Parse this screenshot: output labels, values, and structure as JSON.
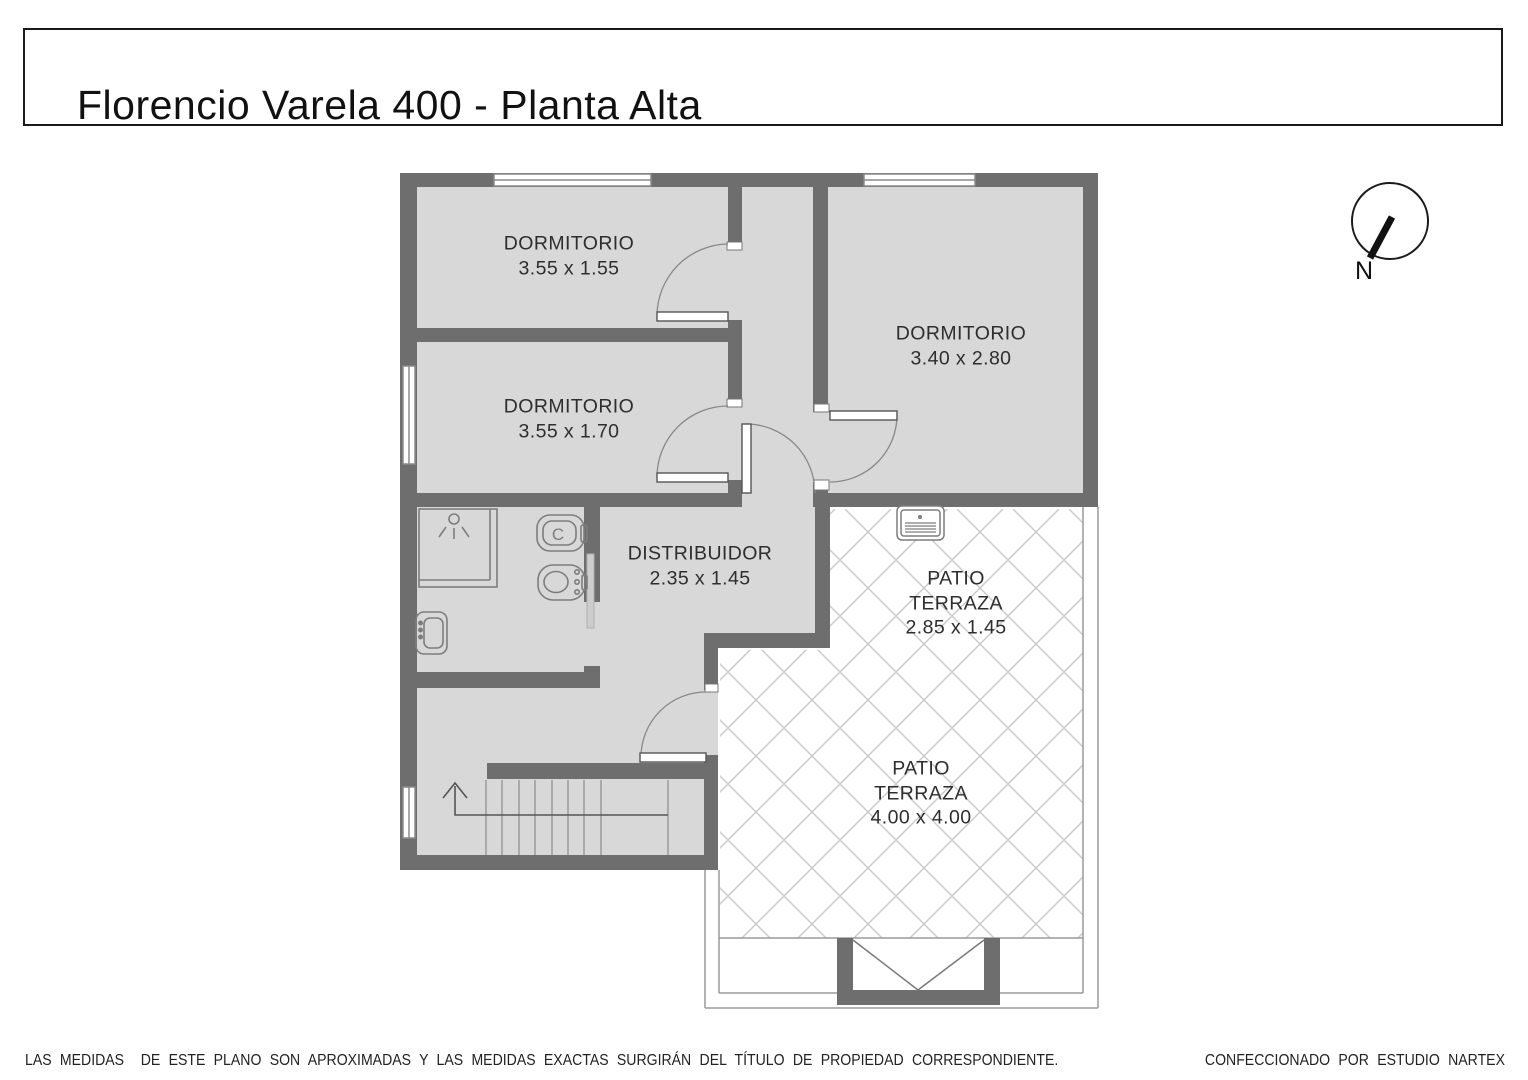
{
  "title": "Florencio Varela 400 - Planta Alta",
  "compass": {
    "label": "N"
  },
  "rooms": [
    {
      "id": "dormitorio-1",
      "lines": [
        "DORMITORIO",
        "3.55 x 1.55"
      ]
    },
    {
      "id": "dormitorio-2",
      "lines": [
        "DORMITORIO",
        "3.55 x 1.70"
      ]
    },
    {
      "id": "dormitorio-3",
      "lines": [
        "DORMITORIO",
        "3.40 x 2.80"
      ]
    },
    {
      "id": "distribuidor",
      "lines": [
        "DISTRIBUIDOR",
        "2.35 x 1.45"
      ]
    },
    {
      "id": "patio-terraza-1",
      "lines": [
        "PATIO",
        "TERRAZA",
        "2.85 x 1.45"
      ]
    },
    {
      "id": "patio-terraza-2",
      "lines": [
        "PATIO",
        "TERRAZA",
        "4.00 x 4.00"
      ]
    }
  ],
  "fixtures": {
    "toilet_letter": "C"
  },
  "footer": {
    "disclaimer": "LAS MEDIDAS  DE ESTE PLANO SON APROXIMADAS Y LAS MEDIDAS EXACTAS SURGIRÁN DEL TÍTULO DE PROPIEDAD CORRESPONDIENTE.",
    "credit": "CONFECCIONADO POR ESTUDIO NARTEX"
  },
  "colors": {
    "wall": "#6e6e6e",
    "floor": "#d8d8d8",
    "hatch": "#c8c8c8",
    "fixture_stroke": "#7d7d7d",
    "text": "#2e2e2e"
  }
}
